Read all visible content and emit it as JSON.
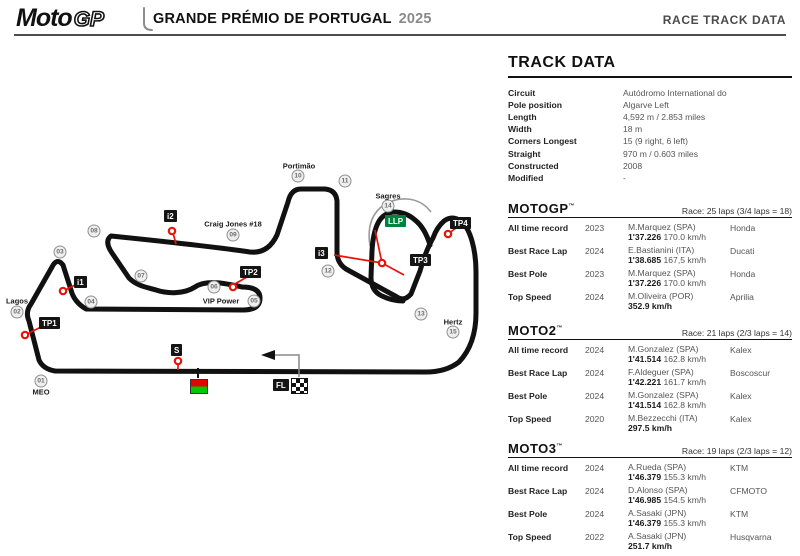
{
  "header": {
    "logo_moto": "Moto",
    "logo_gp": "GP",
    "event_title": "GRANDE PRÉMIO DE PORTUGAL",
    "event_year": "2025",
    "page_label": "RACE TRACK DATA"
  },
  "track_data": {
    "title": "TRACK DATA",
    "rows": [
      {
        "label": "Circuit",
        "value": "Autódromo International do"
      },
      {
        "label": "Pole position",
        "value": "Algarve Left"
      },
      {
        "label": "Length",
        "value": "4,592 m / 2.853 miles"
      },
      {
        "label": "Width",
        "value": "18 m"
      },
      {
        "label": "Corners Longest",
        "value": "15 (9 right, 6 left)"
      },
      {
        "label": "Straight",
        "value": "970 m / 0.603 miles"
      },
      {
        "label": "Constructed",
        "value": "2008"
      },
      {
        "label": "Modified",
        "value": "-"
      }
    ]
  },
  "race_sections": [
    {
      "title": "MOTOGP",
      "tm": "™",
      "race": "Race: 25 laps (3/4 laps = 18)",
      "rows": [
        {
          "label": "All time record",
          "year": "2023",
          "rider": "M.Marquez (SPA)",
          "time": "1'37.226",
          "speed": "170.0 km/h",
          "bike": "Honda"
        },
        {
          "label": "Best Race Lap",
          "year": "2024",
          "rider": "E.Bastianini (ITA)",
          "time": "1'38.685",
          "speed": "167,5 km/h",
          "bike": "Ducati"
        },
        {
          "label": "Best Pole",
          "year": "2023",
          "rider": "M.Marquez (SPA)",
          "time": "1'37.226",
          "speed": "170.0 km/h",
          "bike": "Honda"
        },
        {
          "label": "Top Speed",
          "year": "2024",
          "rider": "M.Oliveira (POR)",
          "time": "352.9 km/h",
          "speed": "",
          "bike": "Aprilia"
        }
      ]
    },
    {
      "title": "MOTO2",
      "tm": "™",
      "race": "Race: 21 laps (2/3 laps = 14)",
      "rows": [
        {
          "label": "All time record",
          "year": "2024",
          "rider": "M.Gonzalez (SPA)",
          "time": "1'41.514",
          "speed": "162.8 km/h",
          "bike": "Kalex"
        },
        {
          "label": "Best Race Lap",
          "year": "2024",
          "rider": "F.Aldeguer (SPA)",
          "time": "1'42.221",
          "speed": "161.7 km/h",
          "bike": "Boscoscur"
        },
        {
          "label": "Best Pole",
          "year": "2024",
          "rider": "M.Gonzalez (SPA)",
          "time": "1'41.514",
          "speed": "162.8 km/h",
          "bike": "Kalex"
        },
        {
          "label": "Top Speed",
          "year": "2020",
          "rider": "M.Bezzecchi (ITA)",
          "time": "297.5 km/h",
          "speed": "",
          "bike": "Kalex"
        }
      ]
    },
    {
      "title": "MOTO3",
      "tm": "™",
      "race": "Race: 19 laps (2/3 laps = 12)",
      "rows": [
        {
          "label": "All time record",
          "year": "2024",
          "rider": "A.Rueda (SPA)",
          "time": "1'46.379",
          "speed": "155.3 km/h",
          "bike": "KTM"
        },
        {
          "label": "Best Race Lap",
          "year": "2024",
          "rider": "D.Alonso (SPA)",
          "time": "1'46.985",
          "speed": "154.5 km/h",
          "bike": "CFMOTO"
        },
        {
          "label": "Best Pole",
          "year": "2024",
          "rider": "A.Sasaki (JPN)",
          "time": "1'46.379",
          "speed": "155.3 km/h",
          "bike": "KTM"
        },
        {
          "label": "Top Speed",
          "year": "2022",
          "rider": "A.Sasaki (JPN)",
          "time": "251.7 km/h",
          "speed": "",
          "bike": "Husqvarna"
        }
      ]
    }
  ],
  "track_map": {
    "corners": [
      {
        "num": "01",
        "name": "MEO"
      },
      {
        "num": "02",
        "name": "Lagos"
      },
      {
        "num": "03"
      },
      {
        "num": "04"
      },
      {
        "num": "05",
        "name": "VIP Power"
      },
      {
        "num": "06"
      },
      {
        "num": "07"
      },
      {
        "num": "08"
      },
      {
        "num": "09",
        "name": "Craig Jones #18"
      },
      {
        "num": "10",
        "name": "Portimão"
      },
      {
        "num": "11"
      },
      {
        "num": "12"
      },
      {
        "num": "13"
      },
      {
        "num": "14",
        "name": "Sagres"
      },
      {
        "num": "15",
        "name": "Hertz"
      }
    ],
    "markers": [
      {
        "id": "i1",
        "label": "i1",
        "type": "sector"
      },
      {
        "id": "i2",
        "label": "i2",
        "type": "sector"
      },
      {
        "id": "i3",
        "label": "i3",
        "type": "sector"
      },
      {
        "id": "tp1",
        "label": "TP1",
        "type": "sector"
      },
      {
        "id": "tp2",
        "label": "TP2",
        "type": "sector"
      },
      {
        "id": "tp3",
        "label": "TP3",
        "type": "sector"
      },
      {
        "id": "tp4",
        "label": "TP4",
        "type": "sector"
      },
      {
        "id": "llp",
        "label": "LLP",
        "type": "llp"
      },
      {
        "id": "s",
        "label": "S",
        "type": "sector"
      },
      {
        "id": "fl",
        "label": "FL",
        "type": "sector"
      }
    ],
    "colors": {
      "track": "#111111",
      "sector_red": "#e8120a",
      "llp_green": "#00843d",
      "start_light_red": "#e10600",
      "start_light_green": "#00c800"
    }
  }
}
